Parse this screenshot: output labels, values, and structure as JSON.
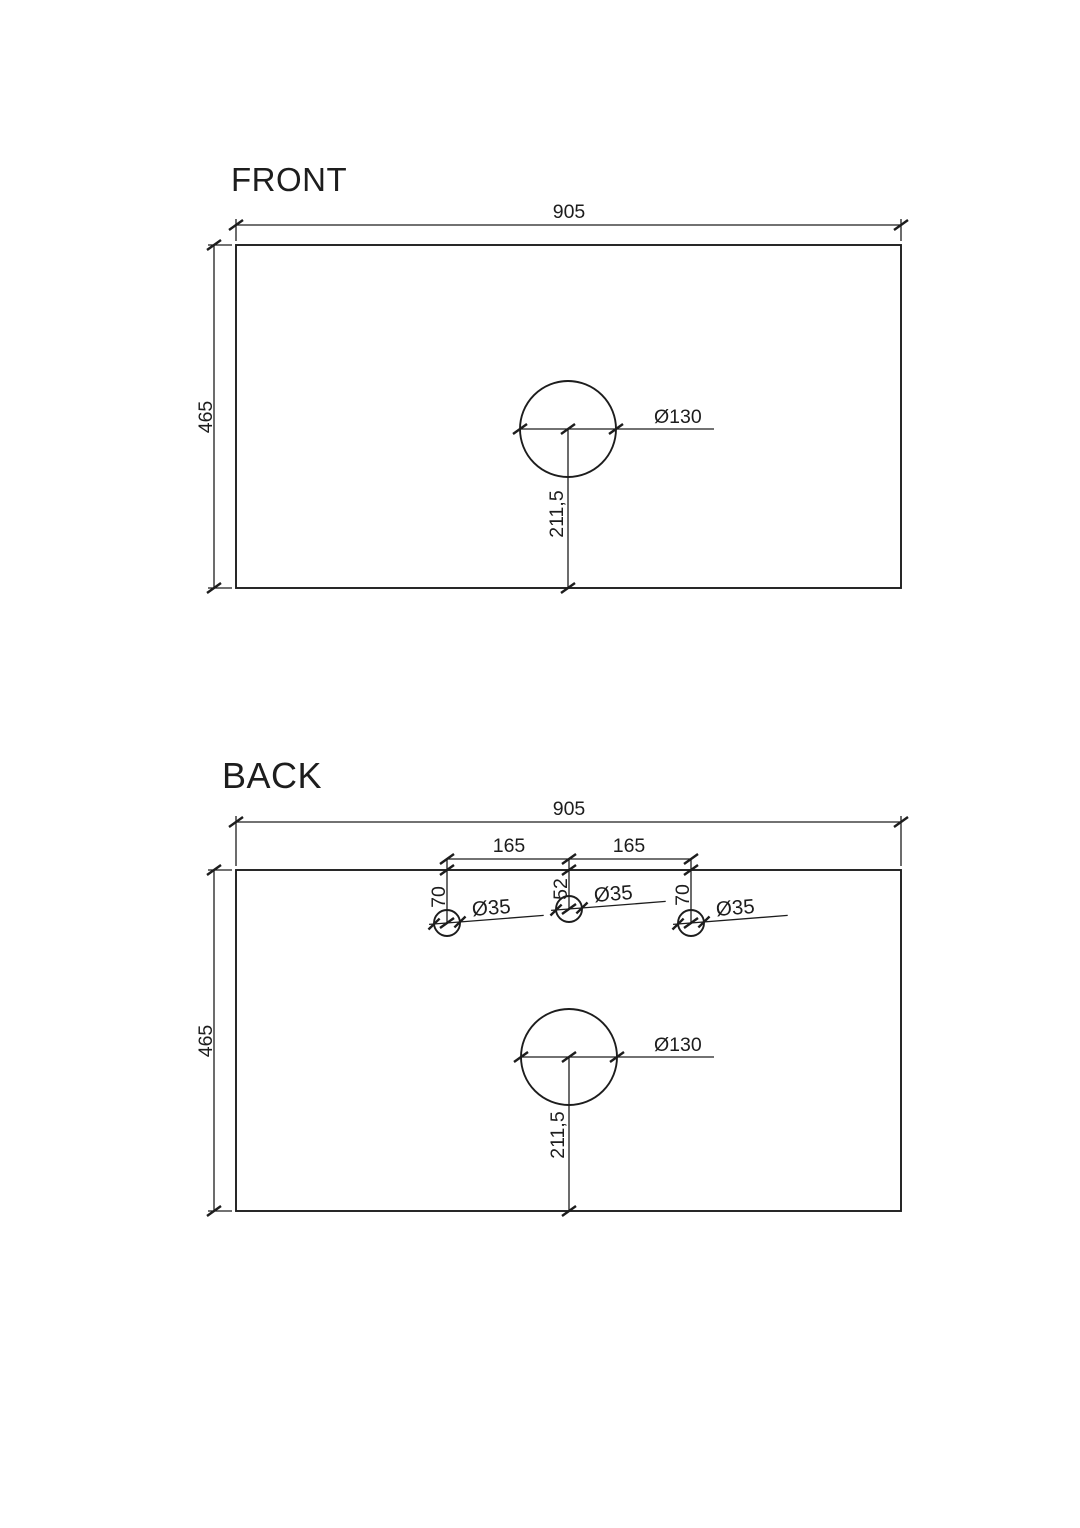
{
  "page": {
    "background_color": "#ffffff",
    "line_color": "#1d1d1d"
  },
  "front": {
    "title": "FRONT",
    "width": "905",
    "height": "465",
    "hole_diameter": "Ø130",
    "hole_center_from_bottom": "211,5"
  },
  "back": {
    "title": "BACK",
    "width": "905",
    "height": "465",
    "tap_spacing_left": "165",
    "tap_spacing_right": "165",
    "tap_depths": [
      "70",
      "52",
      "70"
    ],
    "tap_diameters": [
      "Ø35",
      "Ø35",
      "Ø35"
    ],
    "hole_diameter": "Ø130",
    "hole_center_from_bottom": "211,5"
  }
}
